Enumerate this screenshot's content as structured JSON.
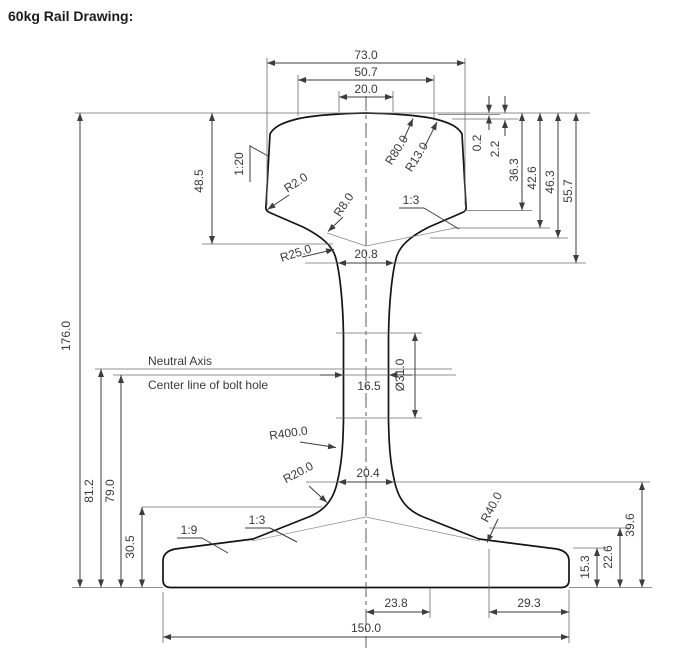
{
  "title": "60kg Rail Drawing:",
  "dims": {
    "d73": "73.0",
    "d50_7": "50.7",
    "d20": "20.0",
    "d0_2": "0.2",
    "d2_2": "2.2",
    "d36_3": "36.3",
    "d42_6": "42.6",
    "d46_3": "46.3",
    "d55_7": "55.7",
    "d48_5": "48.5",
    "d20_8": "20.8",
    "d176": "176.0",
    "d81_2": "81.2",
    "d79": "79.0",
    "d30_5": "30.5",
    "d16_5": "16.5",
    "d31": "Ø31.0",
    "d20_4": "20.4",
    "d39_6": "39.6",
    "d22_6": "22.6",
    "d15_3": "15.3",
    "d23_8": "23.8",
    "d29_3": "29.3",
    "d150": "150.0"
  },
  "radii": {
    "r80": "R80.0",
    "r13": "R13.0",
    "r2": "R2.0",
    "r8": "R8.0",
    "r25": "R25.0",
    "r400": "R400.0",
    "r20": "R20.0",
    "r40": "R40.0"
  },
  "slopes": {
    "s1_20": "1:20",
    "s1_3_head": "1:3",
    "s1_3_foot": "1:3",
    "s1_9": "1:9"
  },
  "notes": {
    "neutral_axis": "Neutral Axis",
    "bolt_center": "Center line of bolt hole"
  },
  "colors": {
    "line": "#3d3d3d",
    "profile": "#141414",
    "background": "#ffffff"
  }
}
